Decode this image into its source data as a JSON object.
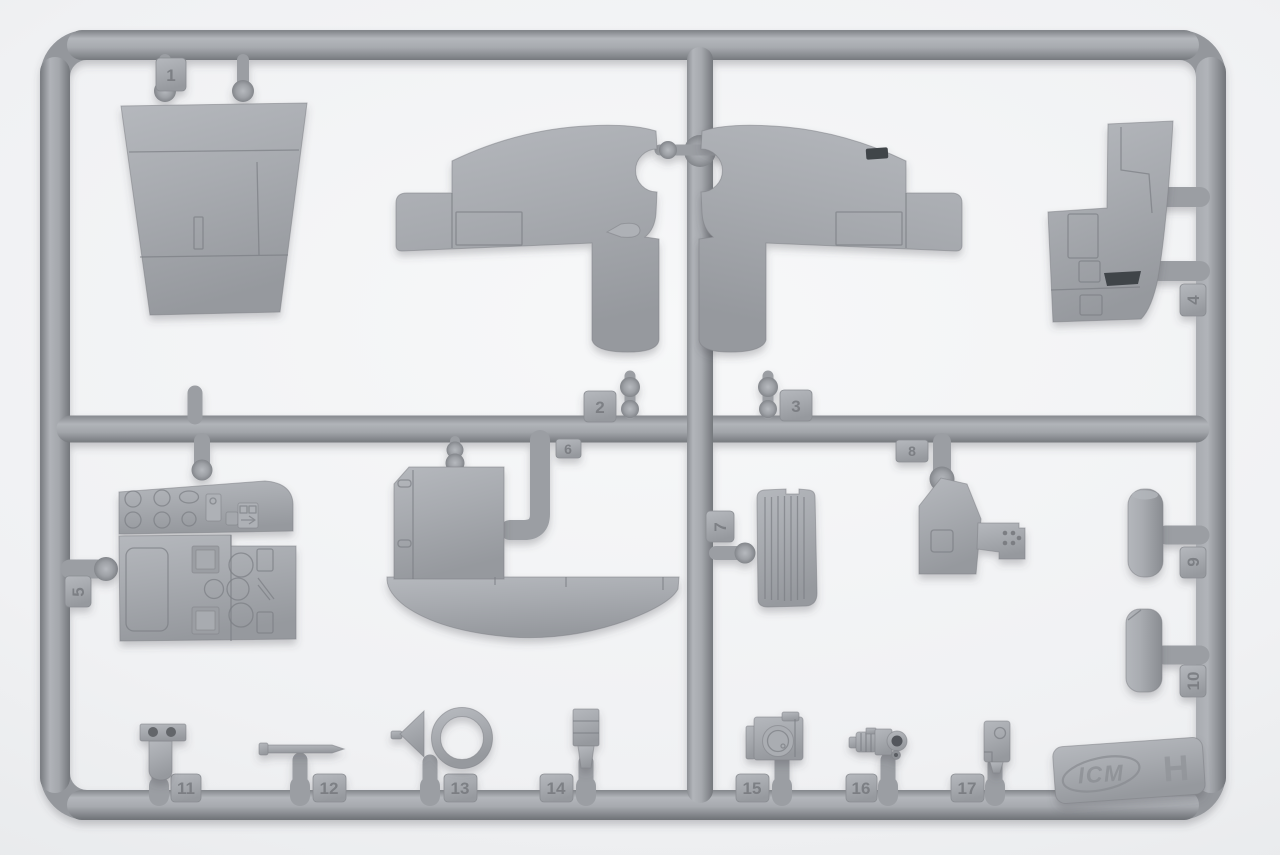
{
  "scene": {
    "description": "Gray injection-molded plastic model-kit sprue (parts frame) photographed on a white backdrop",
    "plastic_color": "#9b9ea3",
    "plastic_highlight": "#b4b7bc",
    "plastic_shadow": "#707378",
    "background_color": "#f0f1f3",
    "dark_slot_color": "#41444a"
  },
  "sprue": {
    "brand_logo": "ICM",
    "frame_letter": "H",
    "parts": [
      {
        "label": "1",
        "name": "trapezoid-fuselage-panel"
      },
      {
        "label": "2",
        "name": "wing-half-left"
      },
      {
        "label": "3",
        "name": "wing-half-right"
      },
      {
        "label": "4",
        "name": "fuselage-side-panel"
      },
      {
        "label": "5",
        "name": "instrument-panel"
      },
      {
        "label": "6",
        "name": "bulkhead-with-curved-skirt"
      },
      {
        "label": "7",
        "name": "ribbed-radiator-panel"
      },
      {
        "label": "8",
        "name": "cockpit-console"
      },
      {
        "label": "9",
        "name": "cylindrical-fairing-upper"
      },
      {
        "label": "10",
        "name": "cylindrical-fairing-lower"
      },
      {
        "label": "11",
        "name": "bracket-with-two-holes"
      },
      {
        "label": "12",
        "name": "gun-barrel"
      },
      {
        "label": "13",
        "name": "ring-sight-with-cone"
      },
      {
        "label": "14",
        "name": "clip-bracket"
      },
      {
        "label": "15",
        "name": "camera-like-fitting"
      },
      {
        "label": "16",
        "name": "gunsight-block"
      },
      {
        "label": "17",
        "name": "small-box-fitting"
      }
    ]
  }
}
